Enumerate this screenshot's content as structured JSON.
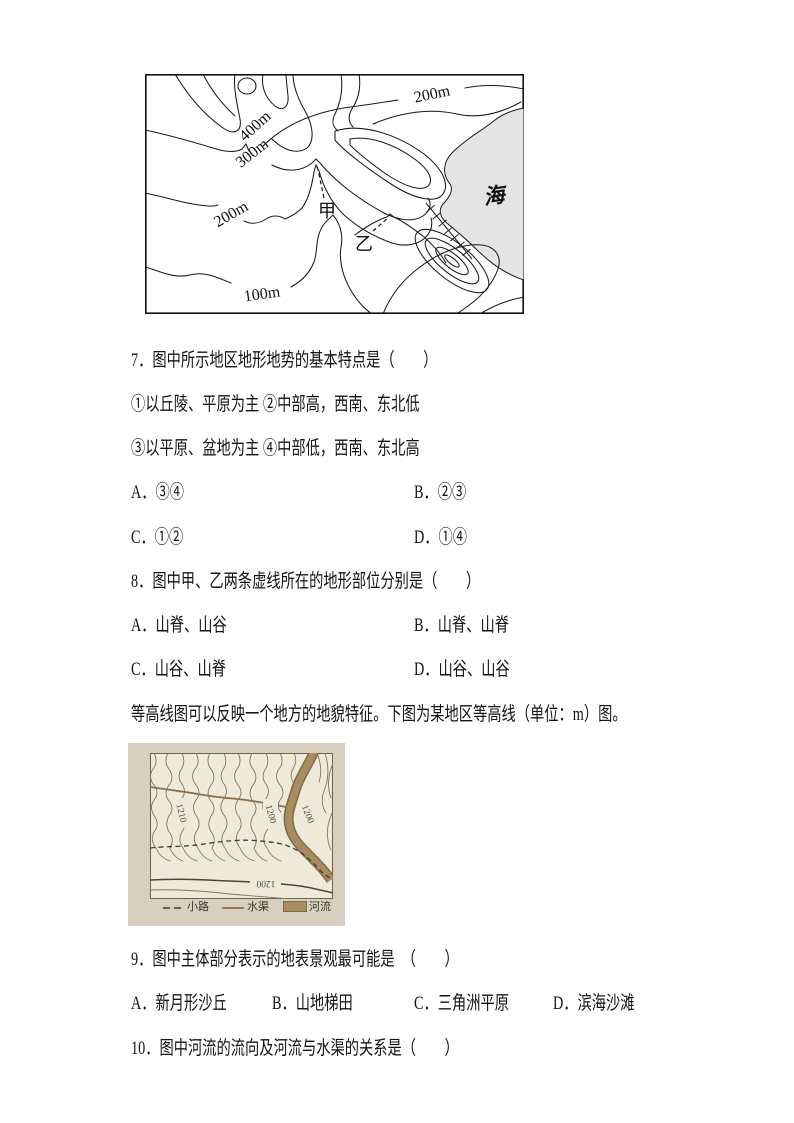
{
  "document": {
    "background": "#ffffff",
    "text_color": "#141414"
  },
  "figure1": {
    "type": "contour-map",
    "sea_fill": "#e4e4e4",
    "line_color": "#1a1a1a",
    "labels": {
      "c200top": "200m",
      "c400": "400m",
      "c300": "300m",
      "c200left": "200m",
      "c100": "100m",
      "jia": "甲",
      "yi": "乙",
      "sea": "海"
    }
  },
  "questions": {
    "q7": {
      "stem": "7．图中所示地区地形地势的基本特点是（　　）",
      "sub1": "①以丘陵、平原为主 ②中部高，西南、东北低",
      "sub2": "③以平原、盆地为主 ④中部低，西南、东北高",
      "optA": "A．③④",
      "optB": "B．②③",
      "optC": "C．①②",
      "optD": "D．①④"
    },
    "q8": {
      "stem": "8．图中甲、乙两条虚线所在的地形部位分别是（　　）",
      "optA": "A．山脊、山谷",
      "optB": "B．山脊、山脊",
      "optC": "C．山谷、山脊",
      "optD": "D．山谷、山谷"
    },
    "intro": "等高线图可以反映一个地方的地貌特征。下图为某地区等高线（单位：m）图。",
    "q9": {
      "stem": "9．图中主体部分表示的地表景观最可能是　（　　）",
      "optA": "A．新月形沙丘",
      "optB": "B．山地梯田",
      "optC": "C．三角洲平原",
      "optD": "D．滨海沙滩"
    },
    "q10": {
      "stem": "10．图中河流的流向及河流与水渠的关系是（　　）"
    }
  },
  "figure2": {
    "type": "scanned-contour-map",
    "colors": {
      "paper": "#d9cfbf",
      "map_bg": "#efe9da",
      "contour": "#84745f",
      "river_fill": "#a88d5e",
      "river_edge": "#7f6a48",
      "canal": "#8a6d49",
      "ink": "#3a342c"
    },
    "elevation_labels": {
      "left": "1210",
      "mid": "1200",
      "right": "1200",
      "bottom": "1200"
    },
    "legend": {
      "path_label": "小路",
      "canal_label": "水渠",
      "river_label": "河流"
    }
  }
}
